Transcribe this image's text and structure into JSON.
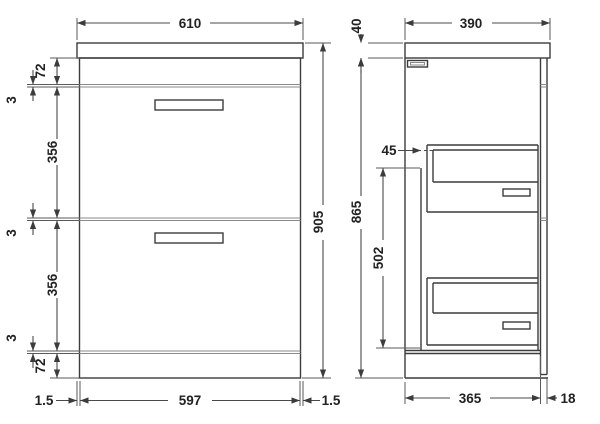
{
  "drawing": {
    "front_view": {
      "width_top": "610",
      "band_top": "72",
      "gap_1": "3",
      "drawer_1_height": "356",
      "gap_2": "3",
      "drawer_2_height": "356",
      "gap_3": "3",
      "band_bottom": "72",
      "height_overall": "905",
      "gap_left": "1.5",
      "width_front": "597",
      "gap_right": "1.5"
    },
    "side_view": {
      "depth_top": "390",
      "worktop_thickness": "40",
      "height_cabinet": "865",
      "back_clearance": "45",
      "drawer_zone_height": "502",
      "depth_cabinet": "365",
      "front_thickness": "18"
    },
    "colors": {
      "line": "#3c3c3c",
      "background": "#ffffff"
    }
  }
}
